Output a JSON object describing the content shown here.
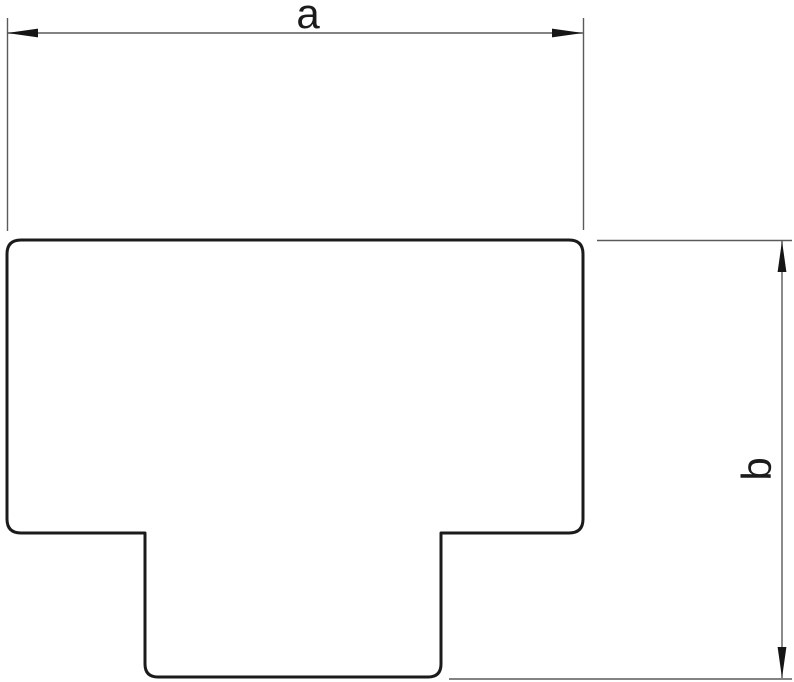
{
  "drawing": {
    "shape_name": "t-piece-outline",
    "dimension_a": {
      "label": "a",
      "orientation": "horizontal",
      "position": "top"
    },
    "dimension_b": {
      "label": "b",
      "orientation": "vertical",
      "position": "right"
    },
    "colors": {
      "outline": "#1b1b1b",
      "dimension_lines": "#5a5a5a",
      "arrows": "#151515",
      "background": "#ffffff"
    }
  }
}
